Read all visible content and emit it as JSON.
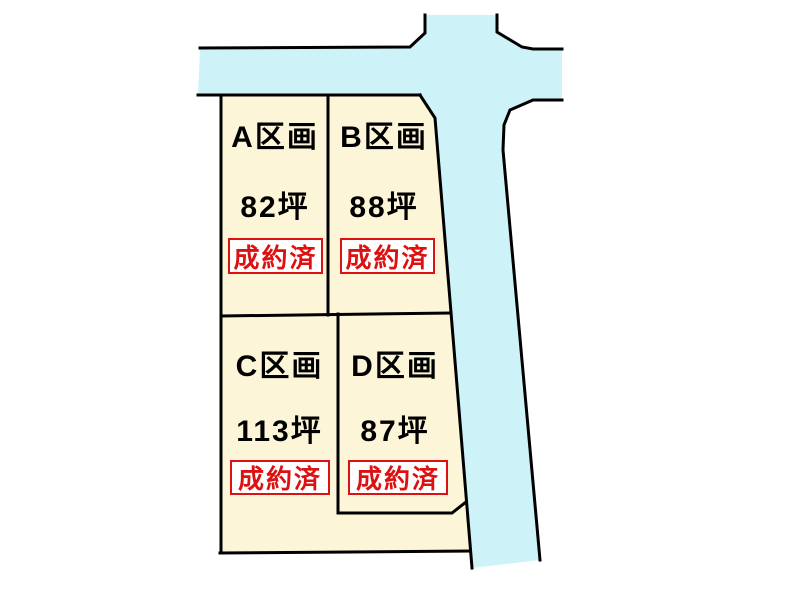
{
  "diagram": {
    "kind": "land-plot-layout",
    "colors": {
      "road_fill": "#cdf3f9",
      "parcel_fill": "#fcf5d7",
      "outline": "#000000",
      "sold_red": "#dd1111",
      "badge_bg": "#ffffff"
    },
    "plots": [
      {
        "name": "A区画",
        "area": "82坪",
        "status": "成約済"
      },
      {
        "name": "B区画",
        "area": "88坪",
        "status": "成約済"
      },
      {
        "name": "C区画",
        "area": "113坪",
        "status": "成約済"
      },
      {
        "name": "D区画",
        "area": "87坪",
        "status": "成約済"
      }
    ]
  }
}
